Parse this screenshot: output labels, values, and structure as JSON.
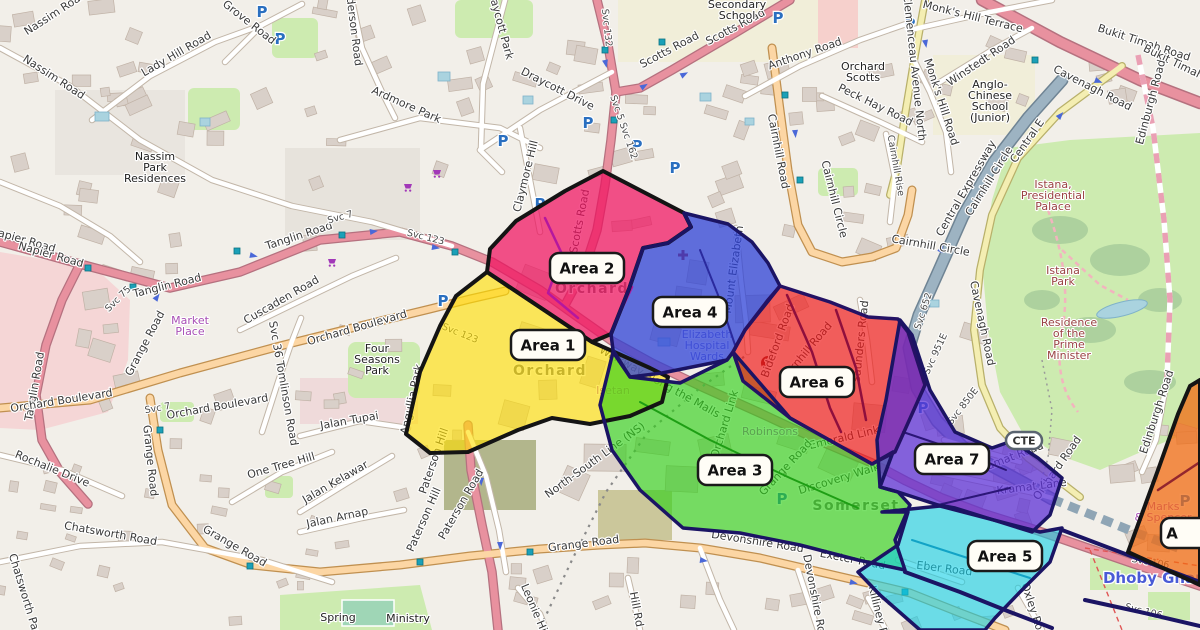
{
  "areas": [
    {
      "id": "area1",
      "label": "Area 1",
      "fill": "#ffdf00",
      "stroke": "#141414",
      "opacity": 0.62
    },
    {
      "id": "area2",
      "label": "Area 2",
      "fill": "#f01060",
      "stroke": "#141414",
      "opacity": 0.72
    },
    {
      "id": "area3",
      "label": "Area 3",
      "fill": "#2fd016",
      "stroke": "#1b1464",
      "opacity": 0.64
    },
    {
      "id": "area4",
      "label": "Area 4",
      "fill": "#2b3fd6",
      "stroke": "#1b1464",
      "opacity": 0.74
    },
    {
      "id": "area5",
      "label": "Area 5",
      "fill": "#10cfe6",
      "stroke": "#1b1464",
      "opacity": 0.6
    },
    {
      "id": "area6",
      "label": "Area 6",
      "fill": "#f01818",
      "stroke": "#241264",
      "opacity": 0.68
    },
    {
      "id": "area7",
      "label": "Area 7",
      "fill": "#5c2fd6",
      "stroke": "#1b1464",
      "opacity": 0.74
    },
    {
      "id": "area8",
      "label": "A",
      "fill": "#f26a12",
      "stroke": "#141414",
      "opacity": 0.74
    }
  ],
  "roads": {
    "nassim1": "Nassim Road",
    "nassim2": "Nassim Road",
    "ladyhill": "Lady Hill Road",
    "grove": "Grove Road",
    "anderson": "Anderson Road",
    "ardmore": "Ardmore Park",
    "draycott_drive": "Draycott Drive",
    "draycott_park": "Draycott Park",
    "claymore": "Claymore Hill",
    "svc132": "Svc 132",
    "scotts1": "Scotts Road",
    "scotts2": "Scotts Road",
    "scotts3": "Scotts Road",
    "svc5_162": "Svc 5 Svc 162",
    "anthony": "Anthony Road",
    "peck_hay": "Peck Hay Road",
    "cairnhill_road": "Cairnhill Road",
    "cairnhill_circle1": "Cairnhill Circle",
    "cairnhill_rise": "Cairnhill Rise",
    "cairnhill_circle2": "Cairnhill Circle",
    "monks_terrace": "Monk's Hill Terrace",
    "winstedt": "Winstedt Road",
    "monks_road": "Monk's Hill Road",
    "bukit1": "Bukit Timah Road",
    "bukit2": "Bukit Timah Road",
    "clemenceau": "Clemenceau Avenue North",
    "cavenagh1": "Cavenagh Road",
    "central_exp": "Central Expressway",
    "cairnhill_circle3": "Cairnhill Circle",
    "central_e": "Central E",
    "cavenagh2": "Cavenagh Road",
    "svc652": "Svc 652",
    "svc951e": "Svc 951E",
    "svc850e": "Svc 850E",
    "edinburgh1": "Edinburgh Road",
    "edinburgh2": "Edinburgh Road",
    "orchard_road": "Orchard Road",
    "svc106a": "Svc 106",
    "svc106b": "Svc 106",
    "kramat_road": "Kramat Road",
    "kramat_lane": "Kramat Lane",
    "mount_elizabeth": "Mount Elizabeth",
    "saunders": "Saunders Road",
    "bideford": "Bideford Road",
    "cairnhill_road2": "Cairnhill Road",
    "emerald": "Emerald Link",
    "walkway": "Walkway along the Malls",
    "orchard_link": "Orchard Link",
    "grange_green": "Grange Road",
    "discovery": "Discovery Walk",
    "devonshire1": "Devonshire Road",
    "exeter": "Exeter Road",
    "devonshire2": "Devonshire Road",
    "killiney": "Killiney Road",
    "eber": "Eber Road",
    "oxley": "Oxley Road",
    "tanglin1": "Tanglin Road",
    "svc7a": "Svc 7",
    "svc123a": "Svc 123",
    "svc123b": "Svc 123",
    "tanglin2": "Tanglin Road",
    "tanglin3": "Tanglin Road",
    "napier1": "Napier Road",
    "napier2": "Napier Road",
    "svc75": "Svc 75",
    "grange75": "Grange Road",
    "cuscaden": "Cuscaden Road",
    "orchard_blvd1": "Orchard Boulevard",
    "orchard_blvd2": "Orchard Boulevard",
    "orchard_blvd3": "Orchard Boulevard",
    "svc7b": "Svc 7",
    "tomlinson": "Svc 36 Tomlinson Road",
    "jalan_tupai": "Jalan Tupai",
    "jalan_kelawar": "Jalan Kelawar",
    "jalan_arnap": "Jalan Arnap",
    "one_tree": "One Tree Hill",
    "rochalie": "Rochalie Drive",
    "chatsworth": "Chatsworth Road",
    "chatsworth_park": "Chatsworth Park",
    "grange_bl1": "Grange Road",
    "grange_bl2": "Grange Road",
    "grange_mid": "Grange Road",
    "paterson1": "Paterson Hill",
    "paterson2": "Paterson Hill",
    "paterson_road": "Paterson Road",
    "ns_line": "North-South Line (NS)",
    "leonie": "Leonie Hill",
    "hill_rd": "Hill Rd",
    "angullia": "Angullia Park"
  },
  "places": {
    "nassim_park": [
      "Nassim",
      "Park",
      "Residences"
    ],
    "secondary_school": [
      "Secondary",
      "School"
    ],
    "orchard_scotts": [
      "Orchard",
      "Scotts"
    ],
    "acs": [
      "Anglo-",
      "Chinese",
      "School",
      "(Junior)"
    ],
    "istana": [
      "Istana,",
      "Presidential",
      "Palace"
    ],
    "istana_park": [
      "Istana",
      "Park"
    ],
    "pm_residence": [
      "Residence",
      "of the",
      "Prime",
      "Minister"
    ],
    "four_seasons": [
      "Four",
      "Seasons",
      "Park"
    ],
    "market_place": [
      "Market",
      "Place"
    ],
    "elizabeth_wards": [
      "Elizabeth",
      "Hospital",
      "Wards"
    ],
    "marks_spencer": [
      "Marks",
      "& Spencer"
    ],
    "dhoby_ghaut": "Dhoby Ghaut",
    "somerset": "Somerset",
    "orchard1": "Orchard",
    "orchard2": "Orchard",
    "isetan": "Isetan",
    "robinsons": "Robinsons",
    "ministry": "Ministry",
    "spring": "Spring"
  },
  "icons": {
    "parking": "P",
    "expressway_shield": "CTE"
  }
}
